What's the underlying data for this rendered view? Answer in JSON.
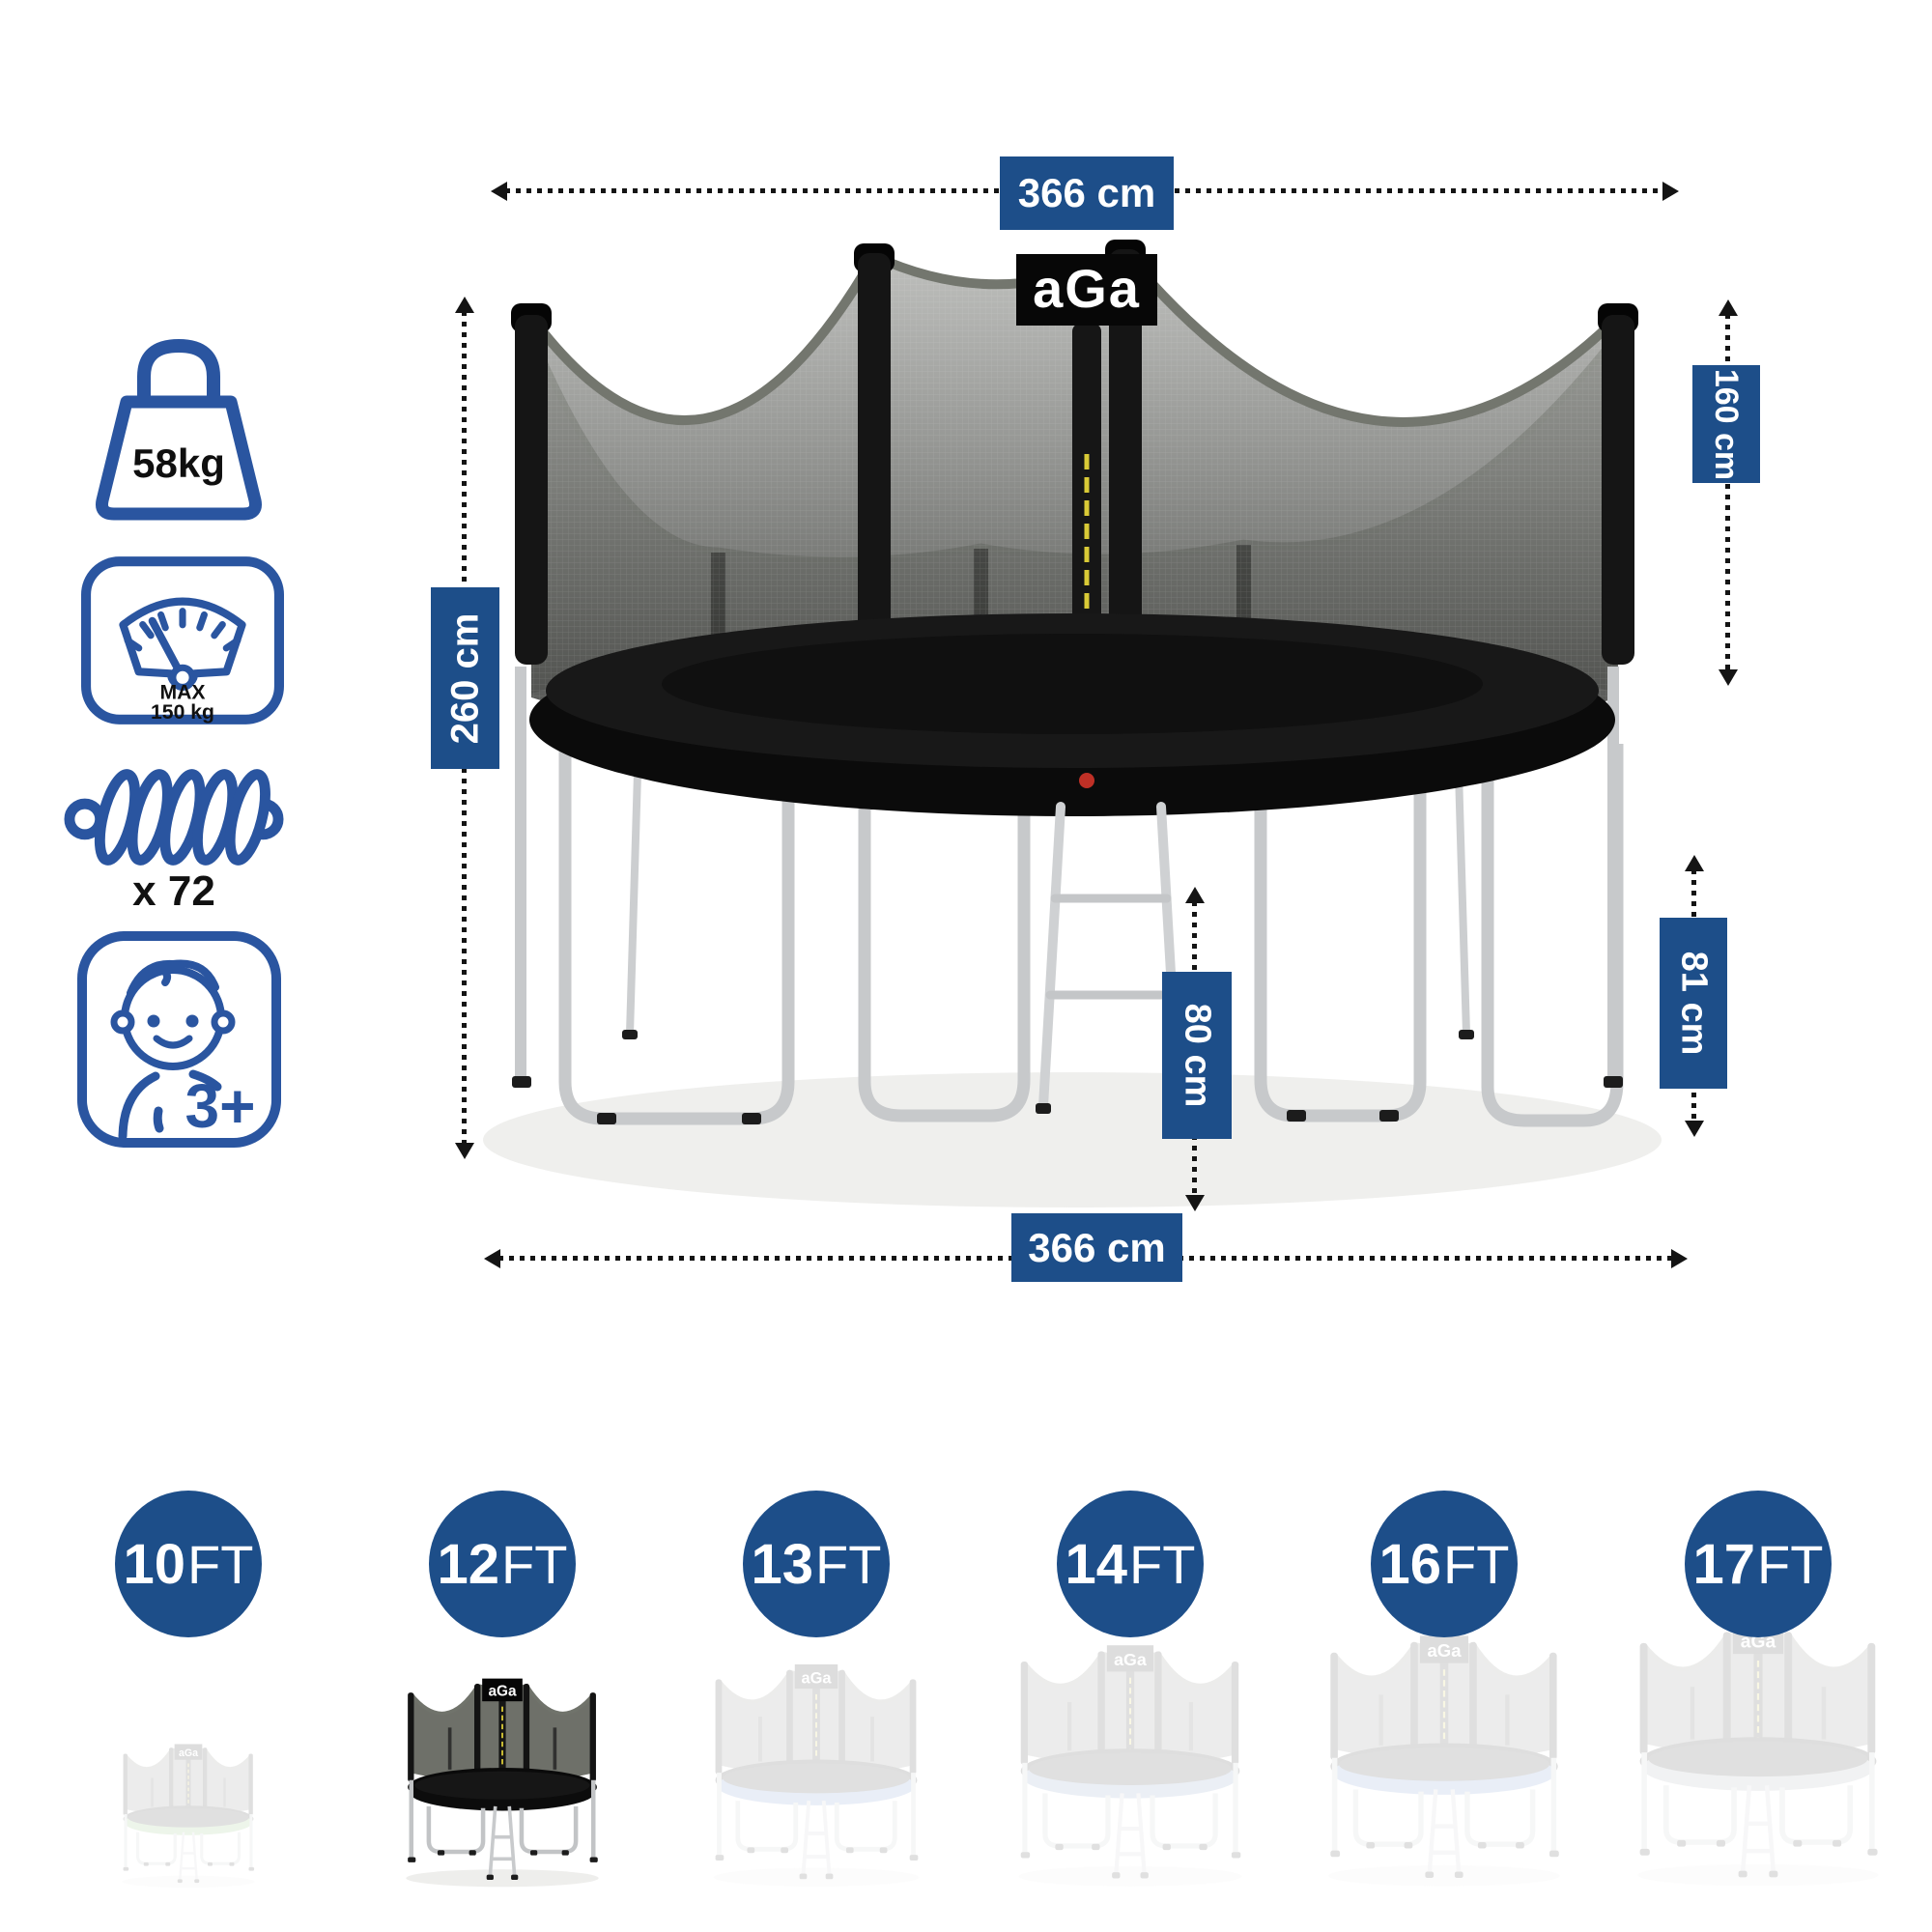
{
  "colors": {
    "accent": "#1d4e89",
    "icon_stroke": "#2a55a0",
    "dash": "#141414"
  },
  "brand": {
    "logo_text": "aGa"
  },
  "specs": {
    "weight": {
      "icon": "weight-icon",
      "value": "58kg"
    },
    "max_load": {
      "icon": "scale-icon",
      "line1": "MAX",
      "line2": "150 kg"
    },
    "springs": {
      "icon": "spring-icon",
      "value": "x 72"
    },
    "age": {
      "icon": "child-icon",
      "value": "3+"
    }
  },
  "dimensions": {
    "top_width": "366 cm",
    "total_height": "260 cm",
    "net_height": "160 cm",
    "frame_height": "81 cm",
    "ladder_height": "80 cm",
    "bottom_width": "366 cm"
  },
  "sizes": [
    {
      "size": "10",
      "unit": "FT",
      "selected": false,
      "tint": "#79b661"
    },
    {
      "size": "12",
      "unit": "FT",
      "selected": true,
      "tint": "#0c0c0c"
    },
    {
      "size": "13",
      "unit": "FT",
      "selected": false,
      "tint": "#5d82c8"
    },
    {
      "size": "14",
      "unit": "FT",
      "selected": false,
      "tint": "#6c87b8"
    },
    {
      "size": "16",
      "unit": "FT",
      "selected": false,
      "tint": "#5d82c8"
    },
    {
      "size": "17",
      "unit": "FT",
      "selected": false,
      "tint": "#9aa0a8"
    }
  ]
}
